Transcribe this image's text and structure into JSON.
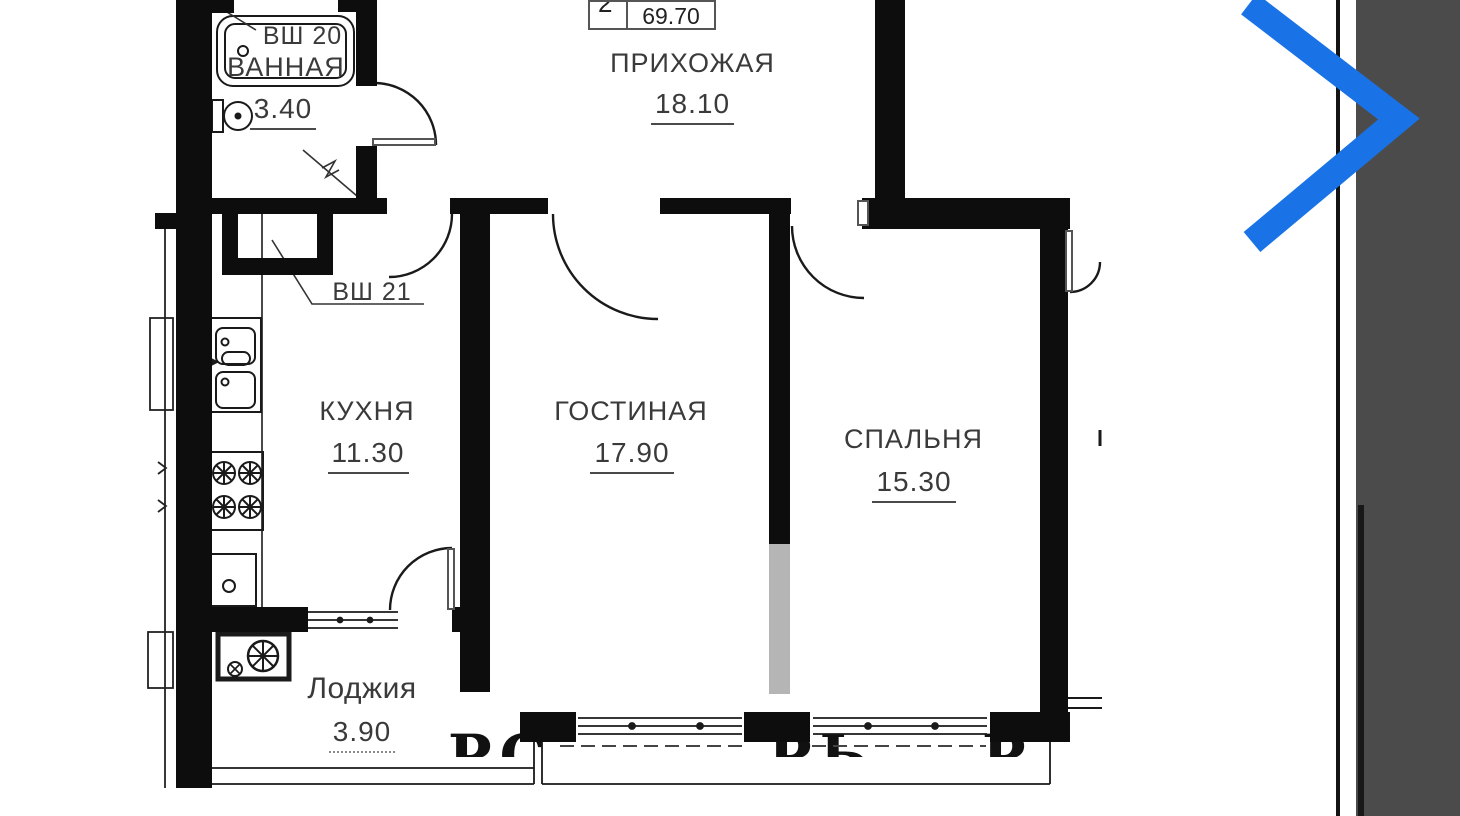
{
  "stamp": {
    "rooms_count": "2",
    "total_area": "69.70"
  },
  "rooms": {
    "hallway": {
      "name": "ПРИХОЖАЯ",
      "area": "18.10"
    },
    "bathroom": {
      "name": "ВАННАЯ",
      "area": "3.40"
    },
    "kitchen": {
      "name": "КУХНЯ",
      "area": "11.30"
    },
    "living": {
      "name": "ГОСТИНАЯ",
      "area": "17.90"
    },
    "bedroom": {
      "name": "СПАЛЬНЯ",
      "area": "15.30"
    },
    "loggia": {
      "name": "Лоджия",
      "area": "3.90"
    }
  },
  "shafts": {
    "vsh20": "ВШ 20",
    "vsh21": "ВШ 21"
  },
  "watermark": {
    "fragments": [
      "РС",
      "РЬ",
      "Р"
    ]
  },
  "colors": {
    "accent_blue": "#1973e6",
    "panel_gray": "#4b4b4b",
    "wall_black": "#0d0d0d",
    "partition_gray": "#b5b5b5"
  }
}
